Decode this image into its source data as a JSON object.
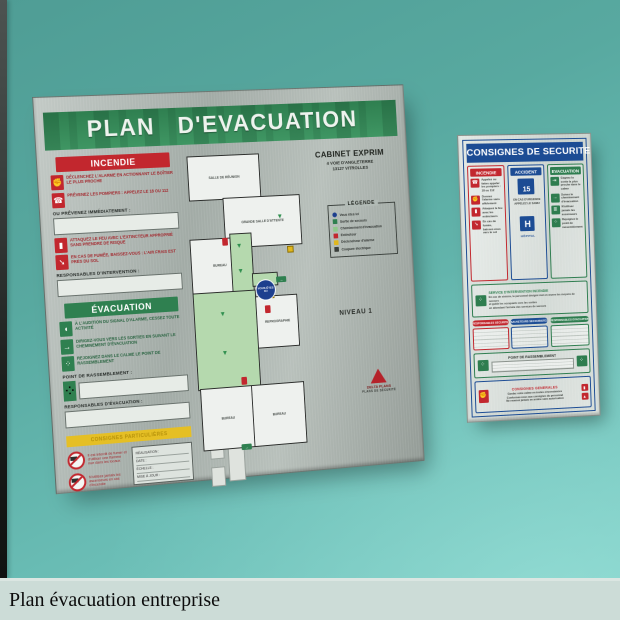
{
  "wall": {
    "color_top": "#4f9d95",
    "color_bottom": "#7fd0c8"
  },
  "caption_bar": {
    "text": "Plan évacuation entreprise",
    "background": "#ccdcd7"
  },
  "evacuation_board": {
    "title": "PLAN D'EVACUATION",
    "header_color": "#2f7f50",
    "client": {
      "name": "CABINET EXPRIM",
      "address1": "4 VOIE D'ANGLETERRE",
      "address2": "13127 VITROLLES"
    },
    "incendie": {
      "header": "INCENDIE",
      "steps": [
        {
          "icon": "alarm-hand-icon",
          "text": "Déclenchez l'alarme en actionnant le boîtier le plus proche"
        },
        {
          "icon": "phone-icon",
          "text": "Prévenez les pompiers : appelez le 18 ou 112"
        },
        {
          "icon": "extinguisher-icon",
          "text": "Attaquez le feu avec l'extincteur approprié sans prendre de risque"
        },
        {
          "icon": "smoke-crawl-icon",
          "text": "En cas de fumée, baissez-vous : l'air frais est près du sol"
        }
      ],
      "notify_label": "OU PRÉVENEZ IMMÉDIATEMENT :",
      "responsables_label": "RESPONSABLES D'INTERVENTION :"
    },
    "evacuation": {
      "header": "ÉVACUATION",
      "steps": [
        {
          "icon": "alarm-sound-icon",
          "text": "À l'audition du signal d'alarme, cessez toute activité"
        },
        {
          "icon": "exit-run-icon",
          "text": "Dirigez-vous vers les sorties en suivant le cheminement d'évacuation"
        },
        {
          "icon": "assembly-icon",
          "text": "Rejoignez dans le calme le point de rassemblement"
        }
      ],
      "point_label": "POINT DE RASSEMBLEMENT :",
      "responsables_label": "RESPONSABLES D'ÉVACUATION :"
    },
    "particulieres_band": "CONSIGNES PARTICULIÈRES",
    "interdictions": [
      {
        "icon": "no-open-flame-icon",
        "text": "Il est interdit de fumer et d'utiliser une flamme nue dans les locaux"
      },
      {
        "icon": "no-elevator-icon",
        "text": "N'utilisez jamais les ascenseurs en cas d'incendie"
      }
    ],
    "doc_box_lines": [
      "RÉALISATION :",
      "DATE :",
      "ÉCHELLE :",
      "MISE À JOUR :"
    ],
    "legend": {
      "title": "LÉGENDE",
      "items": [
        {
          "icon": "you-are-here-swatch",
          "label": "Vous êtes ici",
          "color": "#1d3f8e"
        },
        {
          "icon": "exit-swatch",
          "label": "Sortie de secours",
          "color": "#2f8050"
        },
        {
          "icon": "route-swatch",
          "label": "Cheminement d'évacuation",
          "color": "#8fc98a"
        },
        {
          "icon": "extinguisher-swatch",
          "label": "Extincteur",
          "color": "#c2272e"
        },
        {
          "icon": "alarm-swatch",
          "label": "Déclencheur d'alarme",
          "color": "#e0b71e"
        },
        {
          "icon": "cutoff-swatch",
          "label": "Coupure électrique",
          "color": "#3a3f3b"
        }
      ]
    },
    "niveau": "NIVEAU 1",
    "plan": {
      "rooms": [
        "SALLE DE RÉUNION",
        "GRANDE SALLE D'ATTENTE",
        "BUREAU",
        "ACCUEIL",
        "REPROGRAPHIE",
        "BUREAU",
        "BUREAU"
      ],
      "you_are_here": "VOUS ÊTES ICI"
    },
    "logo_lines": [
      "DELTA PLANS",
      "PLANS DE SÉCURITÉ"
    ]
  },
  "consignes_board": {
    "title": "CONSIGNES DE SECURITE",
    "columns": {
      "incendie": {
        "header": "INCENDIE",
        "rows": [
          {
            "icon": "phone-icon",
            "text": "Appelez ou faites appeler les pompiers : 18 ou 112"
          },
          {
            "icon": "alarm-hand-icon",
            "text": "Donnez l'alarme sans affolement"
          },
          {
            "icon": "extinguisher-icon",
            "text": "Attaquez le feu avec les extincteurs"
          },
          {
            "icon": "smoke-crawl-icon",
            "text": "En cas de fumée, baissez-vous vers le sol"
          }
        ]
      },
      "accident": {
        "header": "ACCIDENT",
        "samu_number": "15",
        "samu_label": "EN CAS D'URGENCE APPELEZ LE SAMU",
        "hospital_letter": "H",
        "hospital_label": "HÔPITAL"
      },
      "evacuation": {
        "header": "EVACUATION",
        "rows": [
          {
            "icon": "exit-icon",
            "text": "Gagnez la sortie la plus proche dans le calme"
          },
          {
            "icon": "run-icon",
            "text": "Suivez le cheminement d'évacuation"
          },
          {
            "icon": "stairs-icon",
            "text": "N'utilisez jamais les ascenseurs"
          },
          {
            "icon": "assembly-icon",
            "text": "Rejoignez le point de rassemblement"
          }
        ]
      }
    },
    "service": {
      "title": "SERVICE D'INTERVENTION INCENDIE",
      "lines": [
        "En cas de sinistre, le personnel désigné met en œuvre les moyens de secours",
        "et guide les occupants vers les sorties",
        "en attendant l'arrivée des services de secours"
      ]
    },
    "pills": [
      {
        "label": "RESPONSABLES SECURITE",
        "color": "#c2272e"
      },
      {
        "label": "SAUVETEURS SECOURISTES",
        "color": "#1c4c94"
      },
      {
        "label": "RESPONSABLES EVACUATION",
        "color": "#2e7d4f"
      }
    ],
    "rassemblement_label": "POINT DE RASSEMBLEMENT",
    "generales": {
      "title": "CONSIGNES GENERALES",
      "lines": [
        "Gardez votre calme en toutes circonstances",
        "Conformez-vous aux consignes du personnel",
        "Ne revenez jamais en arrière sans autorisation"
      ]
    }
  }
}
